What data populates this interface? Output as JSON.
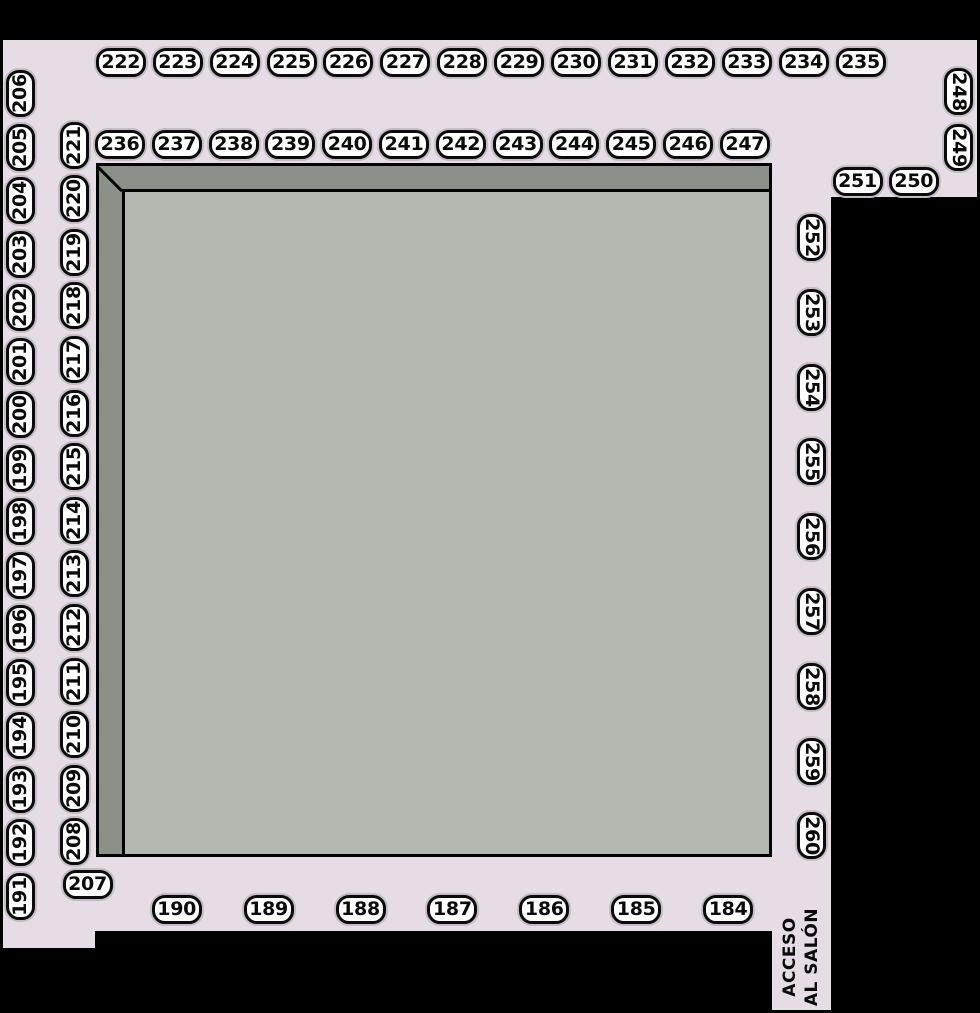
{
  "title": "Floor plan with numbered booths",
  "access": {
    "line1": "ACCESO",
    "line2": "AL SALÓN"
  },
  "colors": {
    "background": "#000000",
    "floor": "#E5DCE5",
    "stage_outer": "#8B9189",
    "stage_inner": "#B3B9B1",
    "booth_fill": "#FFFFFF",
    "booth_text": "#0B0B0B"
  },
  "booths": {
    "top_row": [
      "222",
      "223",
      "224",
      "225",
      "226",
      "227",
      "228",
      "229",
      "230",
      "231",
      "232",
      "233",
      "234",
      "235"
    ],
    "second_row": [
      "236",
      "237",
      "238",
      "239",
      "240",
      "241",
      "242",
      "243",
      "244",
      "245",
      "246",
      "247"
    ],
    "right_top": [
      "248",
      "249"
    ],
    "right_pair": [
      "251",
      "250"
    ],
    "right_column": [
      "252",
      "253",
      "254",
      "255",
      "256",
      "257",
      "258",
      "259",
      "260"
    ],
    "left_outer": [
      "206",
      "205",
      "204",
      "203",
      "202",
      "201",
      "200",
      "199",
      "198",
      "197",
      "196",
      "195",
      "194",
      "193",
      "192",
      "191"
    ],
    "left_inner": [
      "221",
      "220",
      "219",
      "218",
      "217",
      "216",
      "215",
      "214",
      "213",
      "212",
      "211",
      "210",
      "209",
      "208"
    ],
    "corner": [
      "207"
    ],
    "bottom_row": [
      "190",
      "189",
      "188",
      "187",
      "186",
      "185",
      "184"
    ]
  }
}
